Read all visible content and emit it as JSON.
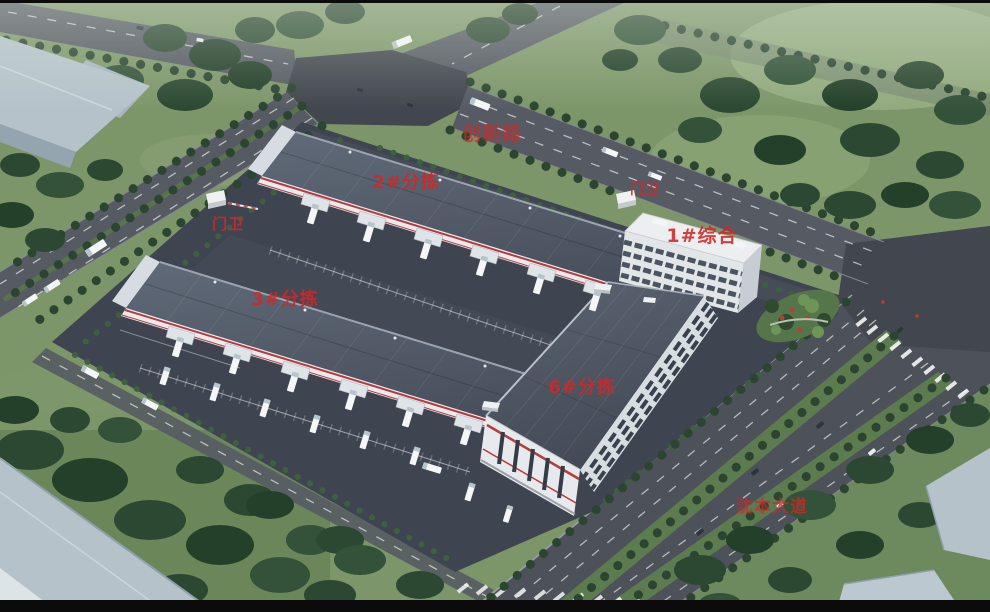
{
  "annotations": {
    "road_north": {
      "label": "创新路"
    },
    "warehouse_2": {
      "label": "2#分拣"
    },
    "gate_east": {
      "label": "门卫"
    },
    "office_1": {
      "label": "1#综合"
    },
    "gate_west": {
      "label": "门卫"
    },
    "warehouse_3": {
      "label": "3#分拣"
    },
    "warehouse_6": {
      "label": "6#分拣"
    },
    "road_southeast": {
      "label": "沈本大道"
    }
  },
  "colors": {
    "annotation_red": "#d02828",
    "grass": "#7d9669",
    "asphalt_campus": "#3e4450",
    "road": "#565b63",
    "avenue": "#4c515a",
    "intersection": "#42464e",
    "roof_slate": "#57606e",
    "building_white": "#e8ebee",
    "stripe_red": "#b93a3a",
    "tree_green": "#2c4832",
    "blue_gray_roof": "#b5c2ca"
  }
}
